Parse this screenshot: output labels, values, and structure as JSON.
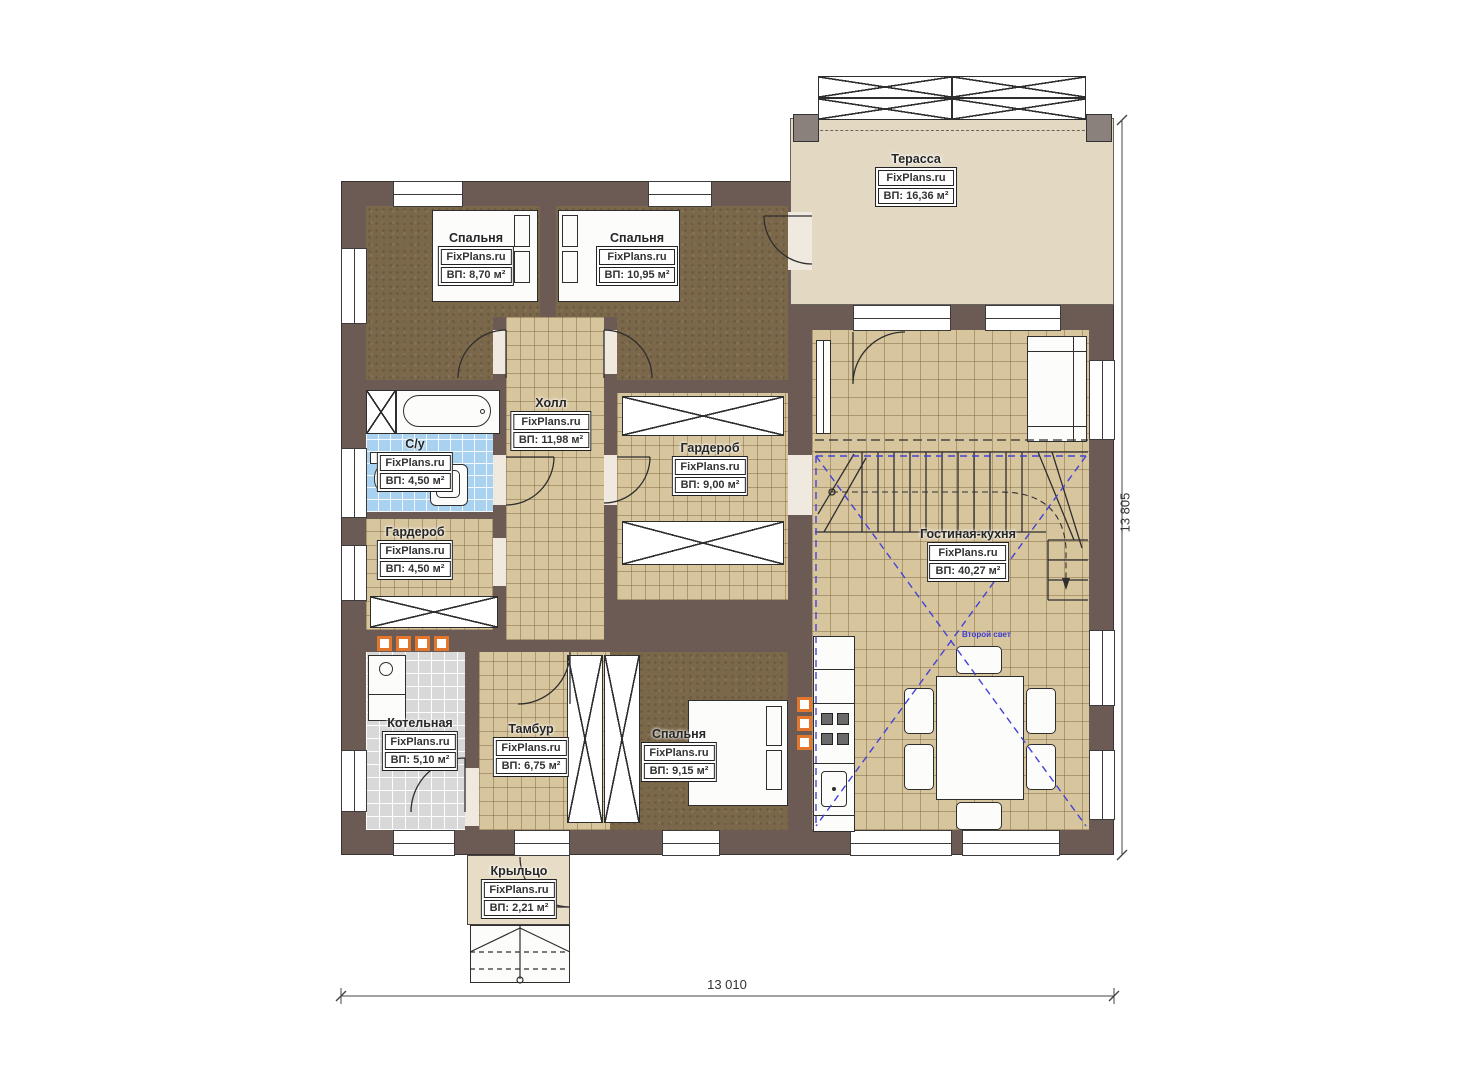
{
  "brand": "FixPlans.ru",
  "rooms": {
    "terrace": {
      "name": "Терасса",
      "area": "ВП: 16,36 м²"
    },
    "bedroom1": {
      "name": "Спальня",
      "area": "ВП: 8,70 м²"
    },
    "bedroom2": {
      "name": "Спальня",
      "area": "ВП: 10,95 м²"
    },
    "hall": {
      "name": "Холл",
      "area": "ВП: 11,98 м²"
    },
    "wardrobe_center": {
      "name": "Гардероб",
      "area": "ВП: 9,00 м²"
    },
    "bathroom": {
      "name": "С/у",
      "area": "ВП: 4,50 м²"
    },
    "wardrobe_left": {
      "name": "Гардероб",
      "area": "ВП: 4,50 м²"
    },
    "living_kitchen": {
      "name": "Гостиная-кухня",
      "area": "ВП: 40,27 м²"
    },
    "boiler": {
      "name": "Котельная",
      "area": "ВП: 5,10 м²"
    },
    "vestibule": {
      "name": "Тамбур",
      "area": "ВП: 6,75 м²"
    },
    "bedroom3": {
      "name": "Спальня",
      "area": "ВП: 9,15 м²"
    },
    "porch": {
      "name": "Крыльцо",
      "area": "ВП: 2,21 м²"
    }
  },
  "dimensions": {
    "width_label": "13 010",
    "height_label": "13 805"
  },
  "annotations": {
    "second_light": "Второй свет"
  },
  "colors": {
    "wall": "#6c5a55",
    "tile_floor": "#d7c59e",
    "bedroom_floor": "#7b684b",
    "bath_floor": "#a9d2f0",
    "boiler_floor": "#d8d8d8",
    "terrace_floor": "#e3d9c3",
    "accent_orange": "#e2762d",
    "accent_blue": "#4343d6"
  }
}
